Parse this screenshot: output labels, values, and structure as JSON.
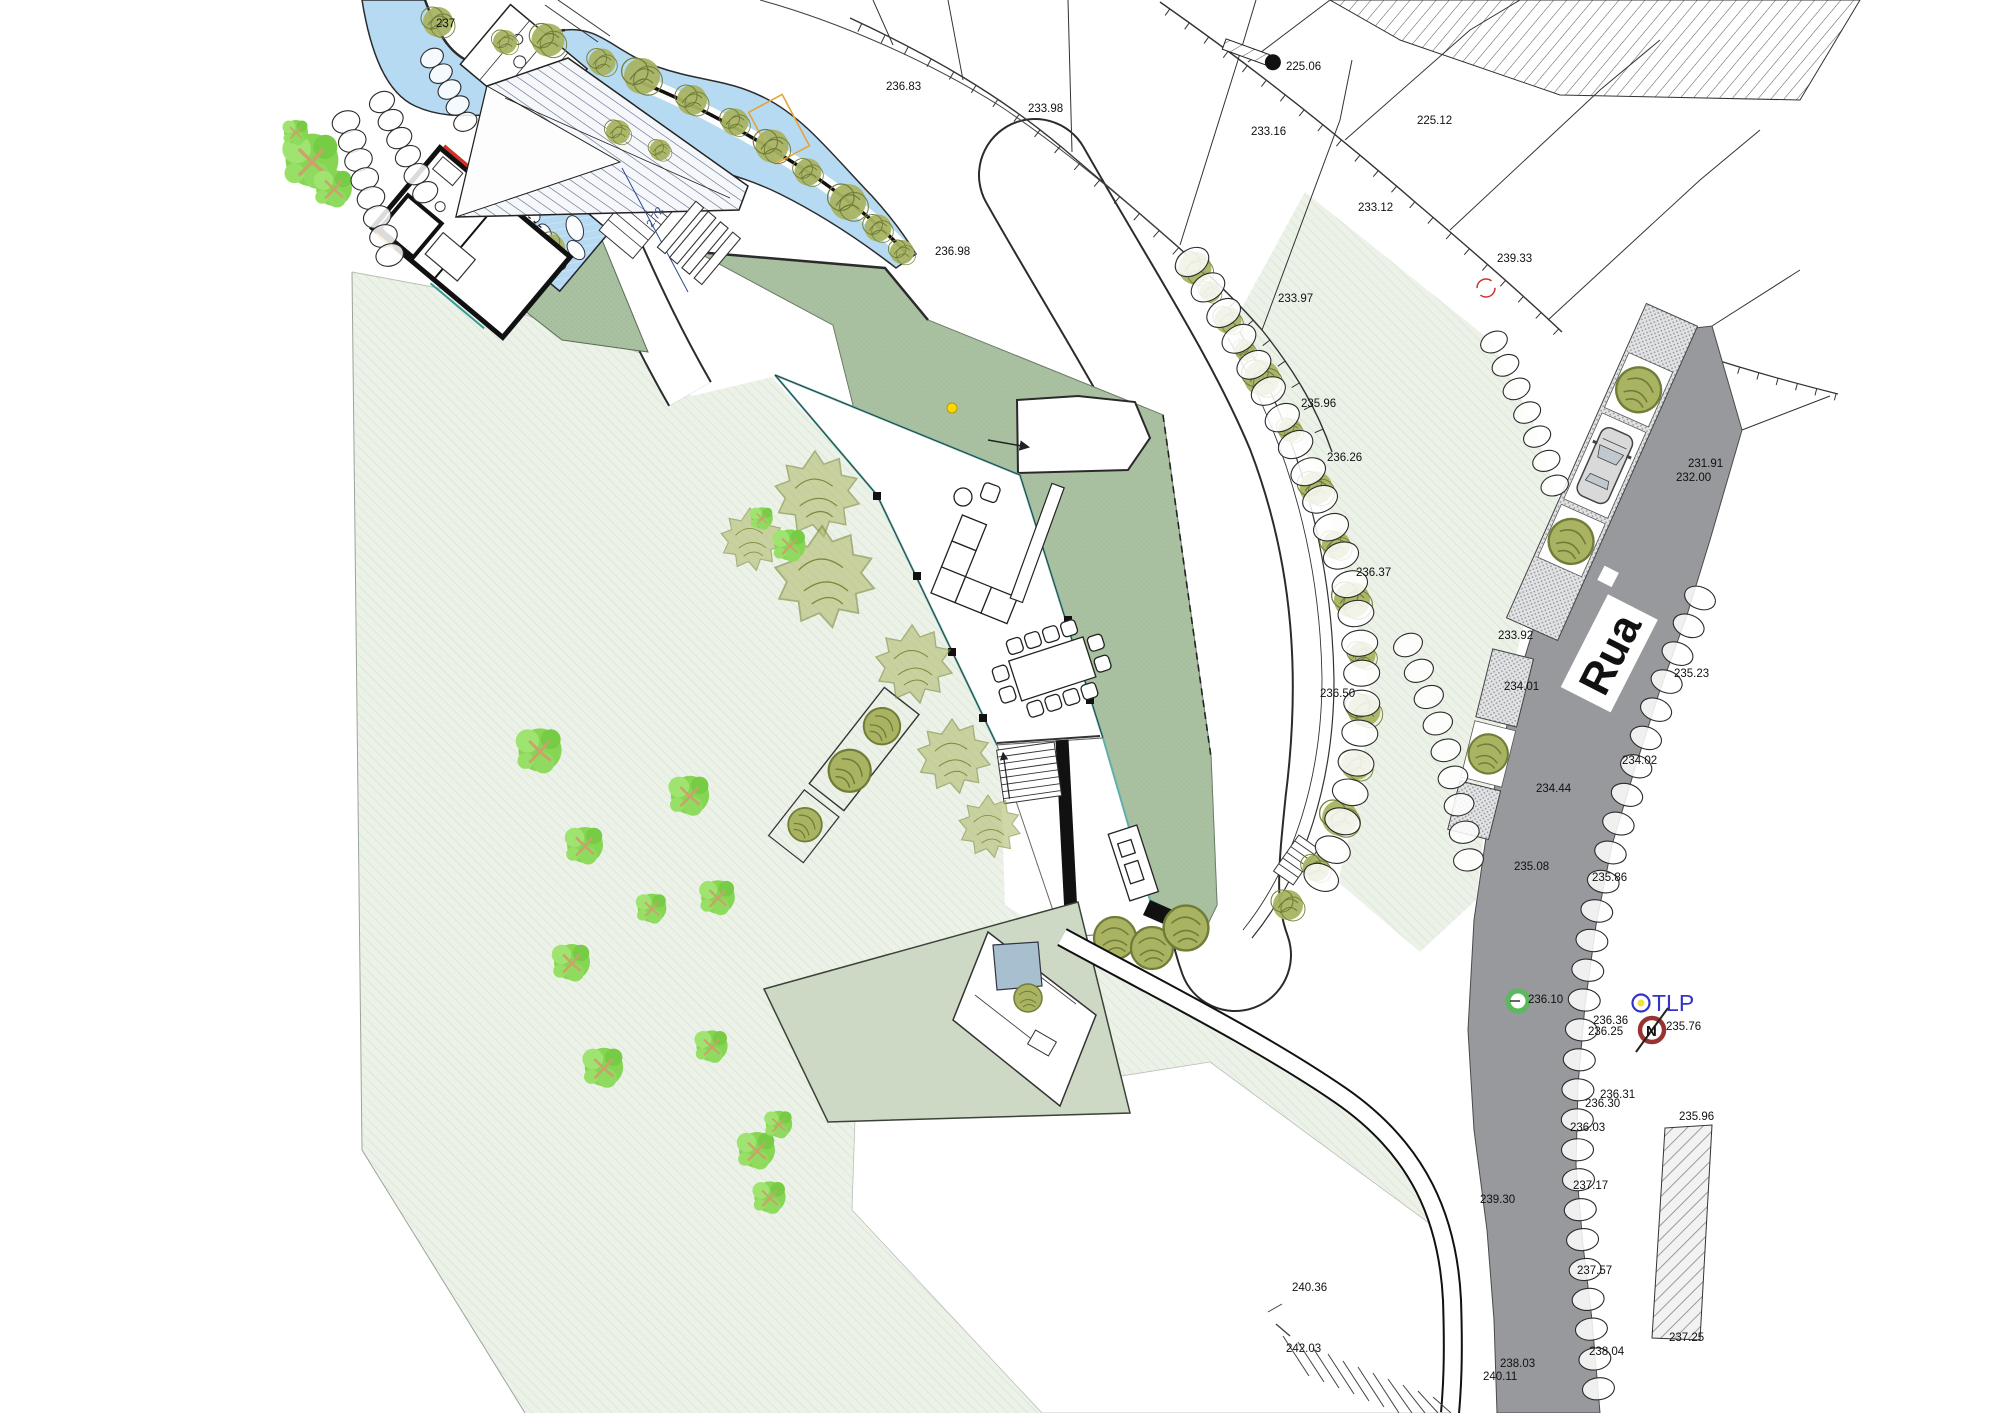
{
  "plan": {
    "street_label": "Rua",
    "utility_pole_label": "TLP",
    "north_label": "N"
  },
  "colors": {
    "road": "#97999c",
    "green_roof": "#a9c1a0",
    "terrace": "#cdd9c5",
    "water": "#b5daf1",
    "pool_lower": "#a7bfcf",
    "tree_olive": "#a9b362",
    "tree_bright": "#86d654",
    "boundary_red": "#d23228",
    "glass_teal": "#5fb0ac",
    "dimension_blue": "#2e4a8f",
    "utility_blue": "#3333cc",
    "north_red": "#993333",
    "manhole_green": "#5cb85c"
  },
  "elevation_labels": [
    {
      "t": "237",
      "x": 436,
      "y": 27
    },
    {
      "t": "236.83",
      "x": 886,
      "y": 90
    },
    {
      "t": "233.98",
      "x": 1028,
      "y": 112
    },
    {
      "t": "225.06",
      "x": 1286,
      "y": 70
    },
    {
      "t": "225.12",
      "x": 1417,
      "y": 124
    },
    {
      "t": "233.16",
      "x": 1251,
      "y": 135
    },
    {
      "t": "233.12",
      "x": 1358,
      "y": 211
    },
    {
      "t": "239.33",
      "x": 1497,
      "y": 262
    },
    {
      "t": "233.97",
      "x": 1278,
      "y": 302
    },
    {
      "t": "235.96",
      "x": 1301,
      "y": 407
    },
    {
      "t": "236.98",
      "x": 935,
      "y": 255
    },
    {
      "t": "236.26",
      "x": 1327,
      "y": 461
    },
    {
      "t": "236.37",
      "x": 1356,
      "y": 576
    },
    {
      "t": "236.50",
      "x": 1320,
      "y": 697
    },
    {
      "t": "231.91",
      "x": 1688,
      "y": 467
    },
    {
      "t": "232.00",
      "x": 1676,
      "y": 481
    },
    {
      "t": "235.23",
      "x": 1674,
      "y": 677
    },
    {
      "t": "233.92",
      "x": 1498,
      "y": 639
    },
    {
      "t": "234.01",
      "x": 1504,
      "y": 690
    },
    {
      "t": "234.02",
      "x": 1622,
      "y": 764
    },
    {
      "t": "234.44",
      "x": 1536,
      "y": 792
    },
    {
      "t": "235.08",
      "x": 1514,
      "y": 870
    },
    {
      "t": "235.86",
      "x": 1592,
      "y": 881
    },
    {
      "t": "236.10",
      "x": 1528,
      "y": 1003
    },
    {
      "t": "236.36",
      "x": 1593,
      "y": 1024
    },
    {
      "t": "236.25",
      "x": 1588,
      "y": 1035
    },
    {
      "t": "235.76",
      "x": 1666,
      "y": 1030
    },
    {
      "t": "236.31",
      "x": 1600,
      "y": 1098
    },
    {
      "t": "236.30",
      "x": 1585,
      "y": 1107
    },
    {
      "t": "236.03",
      "x": 1570,
      "y": 1131
    },
    {
      "t": "237.17",
      "x": 1573,
      "y": 1189
    },
    {
      "t": "237.57",
      "x": 1577,
      "y": 1274
    },
    {
      "t": "235.96",
      "x": 1679,
      "y": 1120
    },
    {
      "t": "238.04",
      "x": 1589,
      "y": 1355
    },
    {
      "t": "237.25",
      "x": 1669,
      "y": 1341
    },
    {
      "t": "239.30",
      "x": 1480,
      "y": 1203
    },
    {
      "t": "238.03",
      "x": 1500,
      "y": 1367
    },
    {
      "t": "240.11",
      "x": 1483,
      "y": 1380
    },
    {
      "t": "240.36",
      "x": 1292,
      "y": 1291
    },
    {
      "t": "242.03",
      "x": 1286,
      "y": 1352
    }
  ],
  "dimension_labels": [
    {
      "t": "2.72",
      "x": 652,
      "y": 228,
      "r": -57
    }
  ]
}
